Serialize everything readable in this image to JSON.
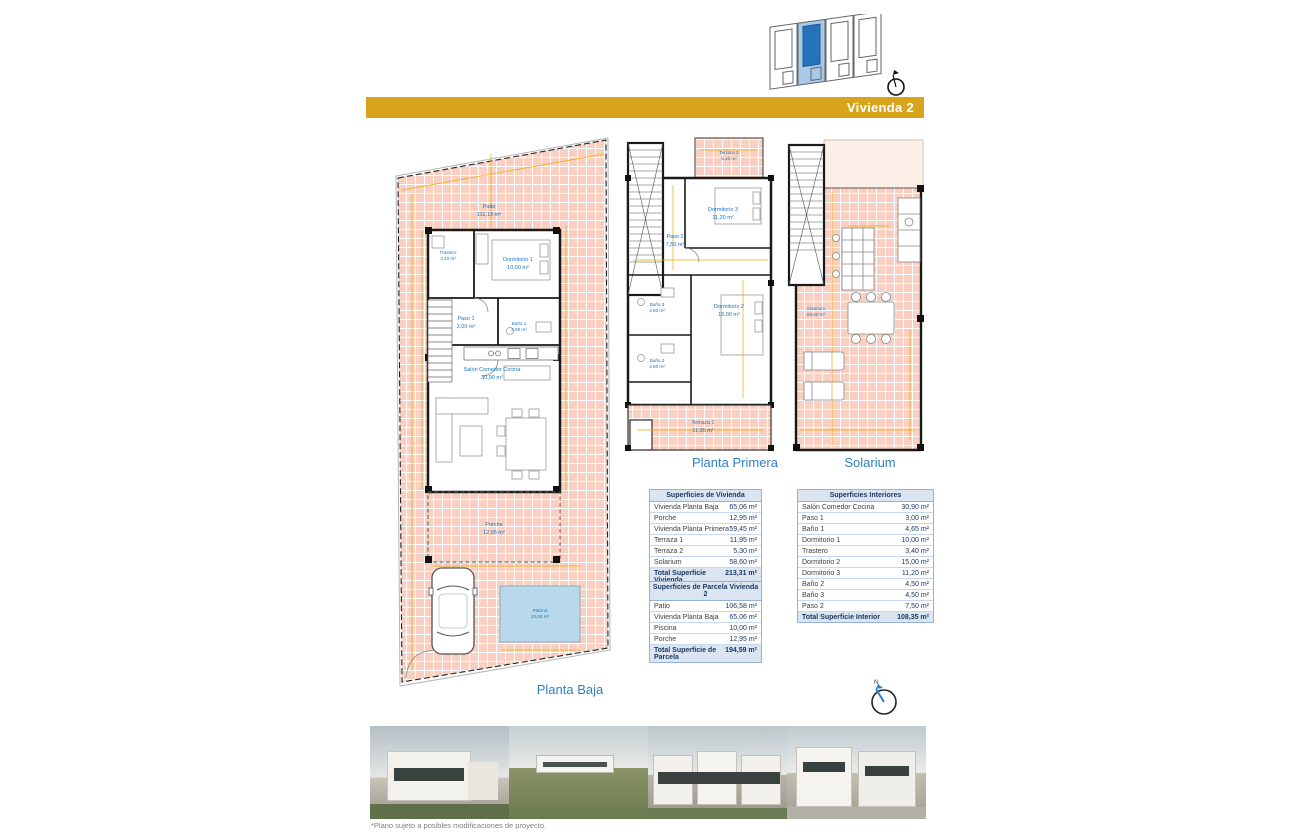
{
  "header": {
    "banner_label": "Vivienda 2"
  },
  "compass": {
    "label": "N"
  },
  "colors": {
    "banner_gold": "#d7a41a",
    "room_label_blue": "#1b74c5",
    "tile_pink": "#f8cfc0",
    "pool_blue": "#b7d9eb",
    "site_highlight": "#2673b8",
    "table_header_bg": "#dbe5f1"
  },
  "plans": {
    "planta_baja": {
      "title": "Planta Baja",
      "rooms": {
        "patio": {
          "name": "Patio",
          "area": "111,13 m²"
        },
        "trastero": {
          "name": "Trastero",
          "area": "3,40 m²"
        },
        "dormitorio1": {
          "name": "Dormitorio 1",
          "area": "10,00 m²"
        },
        "paso1": {
          "name": "Paso 1",
          "area": "3,00 m²"
        },
        "bano1": {
          "name": "Baño 1",
          "area": "4,65 m²"
        },
        "salon": {
          "name": "Salón Comedor Cocina",
          "area": "30,90 m²"
        },
        "porche": {
          "name": "Porche",
          "area": "12,95 m²"
        },
        "piscina": {
          "name": "Piscina",
          "area": "10,00 m²"
        }
      }
    },
    "planta_primera": {
      "title": "Planta Primera",
      "rooms": {
        "terraza2": {
          "name": "Terraza 2",
          "area": "5,30 m²"
        },
        "dormitorio3": {
          "name": "Dormitorio 3",
          "area": "11,20 m²"
        },
        "paso2": {
          "name": "Paso 2",
          "area": "7,50 m²"
        },
        "bano3": {
          "name": "Baño 3",
          "area": "4,50 m²"
        },
        "dormitorio2": {
          "name": "Dormitorio 2",
          "area": "15,00 m²"
        },
        "bano2": {
          "name": "Baño 2",
          "area": "4,50 m²"
        },
        "terraza1": {
          "name": "Terraza 1",
          "area": "11,95 m²"
        }
      }
    },
    "solarium": {
      "title": "Solarium",
      "rooms": {
        "solarium": {
          "name": "Solarium",
          "area": "58,60 m²"
        }
      }
    }
  },
  "tables": {
    "vivienda": {
      "title": "Superficies de Vivienda",
      "rows": [
        {
          "label": "Vivienda Planta Baja",
          "value": "65,06 m²"
        },
        {
          "label": "Porche",
          "value": "12,95 m²"
        },
        {
          "label": "Vivienda Planta Primera",
          "value": "59,45 m²"
        },
        {
          "label": "Terraza 1",
          "value": "11,95 m²"
        },
        {
          "label": "Terraza 2",
          "value": "5,30 m²"
        },
        {
          "label": "Solarium",
          "value": "58,60 m²"
        }
      ],
      "total": {
        "label": "Total Superficie Vivienda",
        "value": "213,31 m²"
      }
    },
    "parcela": {
      "title": "Superficies de Parcela Vivienda 2",
      "rows": [
        {
          "label": "Patio",
          "value": "106,58 m²"
        },
        {
          "label": "Vivienda Planta Baja",
          "value": "65,06 m²"
        },
        {
          "label": "Piscina",
          "value": "10,00 m²"
        },
        {
          "label": "Porche",
          "value": "12,95 m²"
        }
      ],
      "total": {
        "label": "Total Superficie de Parcela",
        "value": "194,59 m²"
      }
    },
    "interiores": {
      "title": "Superficies Interiores",
      "rows": [
        {
          "label": "Salón Comedor Cocina",
          "value": "30,90 m²"
        },
        {
          "label": "Paso 1",
          "value": "3,00 m²"
        },
        {
          "label": "Baño 1",
          "value": "4,65 m²"
        },
        {
          "label": "Dormitorio 1",
          "value": "10,00 m²"
        },
        {
          "label": "Trastero",
          "value": "3,40 m²"
        },
        {
          "label": "Dormitorio 2",
          "value": "15,00 m²"
        },
        {
          "label": "Dormitorio 3",
          "value": "11,20 m²"
        },
        {
          "label": "Baño 2",
          "value": "4,50 m²"
        },
        {
          "label": "Baño 3",
          "value": "4,50 m²"
        },
        {
          "label": "Paso 2",
          "value": "7,50 m²"
        }
      ],
      "total": {
        "label": "Total Superficie Interior",
        "value": "108,35 m²"
      }
    }
  },
  "footnote": "*Plano sujeto a posibles modificaciones de proyecto."
}
